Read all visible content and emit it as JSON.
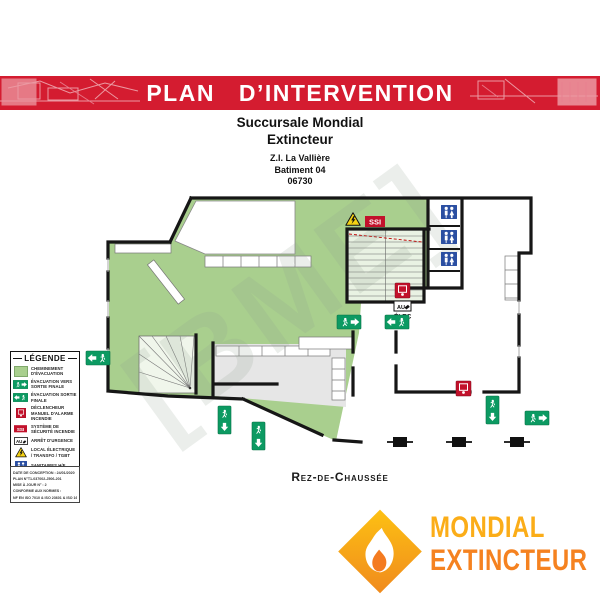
{
  "banner": {
    "title": "PLAN D’INTERVENTION"
  },
  "header": {
    "title_line1": "Succursale Mondial",
    "title_line2": "Extincteur",
    "address": [
      "Z.I. La Vallière",
      "Batiment 04",
      "06730"
    ]
  },
  "legend": {
    "title": "LÉGENDE",
    "items": [
      {
        "icon": "evacuation-path-swatch",
        "label": "CHEMINEMENT D'ÉVACUATION"
      },
      {
        "icon": "exit-arrow-sign",
        "label": "ÉVACUATION VERS SORTIE FINALE"
      },
      {
        "icon": "exit-man-sign",
        "label": "ÉVACUATION SORTIE FINALE"
      },
      {
        "icon": "manual-alarm-icon",
        "label": "DÉCLENCHEUR MANUEL D'ALARME INCENDIE"
      },
      {
        "icon": "ssi-icon",
        "label": "SYSTÈME DE SÉCURITÉ INCENDIE"
      },
      {
        "icon": "emergency-stop-icon",
        "label": "ARRÊT D'URGENCE"
      },
      {
        "icon": "electrical-warning-icon",
        "label": "LOCAL ÉLECTRIQUE / TRANSFO / TGBT"
      },
      {
        "icon": "sanitary-icon",
        "label": "SANITAIRES H/F"
      }
    ],
    "notes": [
      "DATE DE CONCEPTION : 24/01/2020",
      "PLAN N°T1-037002-J506-201",
      "MISE À JOUR N° : 2",
      "CONFORME AUX NORMES :",
      "NF EN ISO 7010 & ISO 23601 & ISO 16069-2"
    ]
  },
  "plan": {
    "floor_label": "Rez-de-Chaussée",
    "ssi_label": "SSI",
    "au_label": "AU",
    "elec_label": "ÉLEC",
    "watermark": "[BME]"
  },
  "logo": {
    "line1": "MONDIAL",
    "line2": "EXTINCTEUR"
  },
  "colors": {
    "banner_red": "#D41C30",
    "evac_green": "#A9CF8E",
    "sign_green": "#0C9A62",
    "alarm_red": "#C2112B",
    "sanitary_blue": "#2B4FA2",
    "warning_yellow": "#F5D214",
    "logo_yellow": "#FBAD18",
    "logo_orange": "#F58220"
  }
}
